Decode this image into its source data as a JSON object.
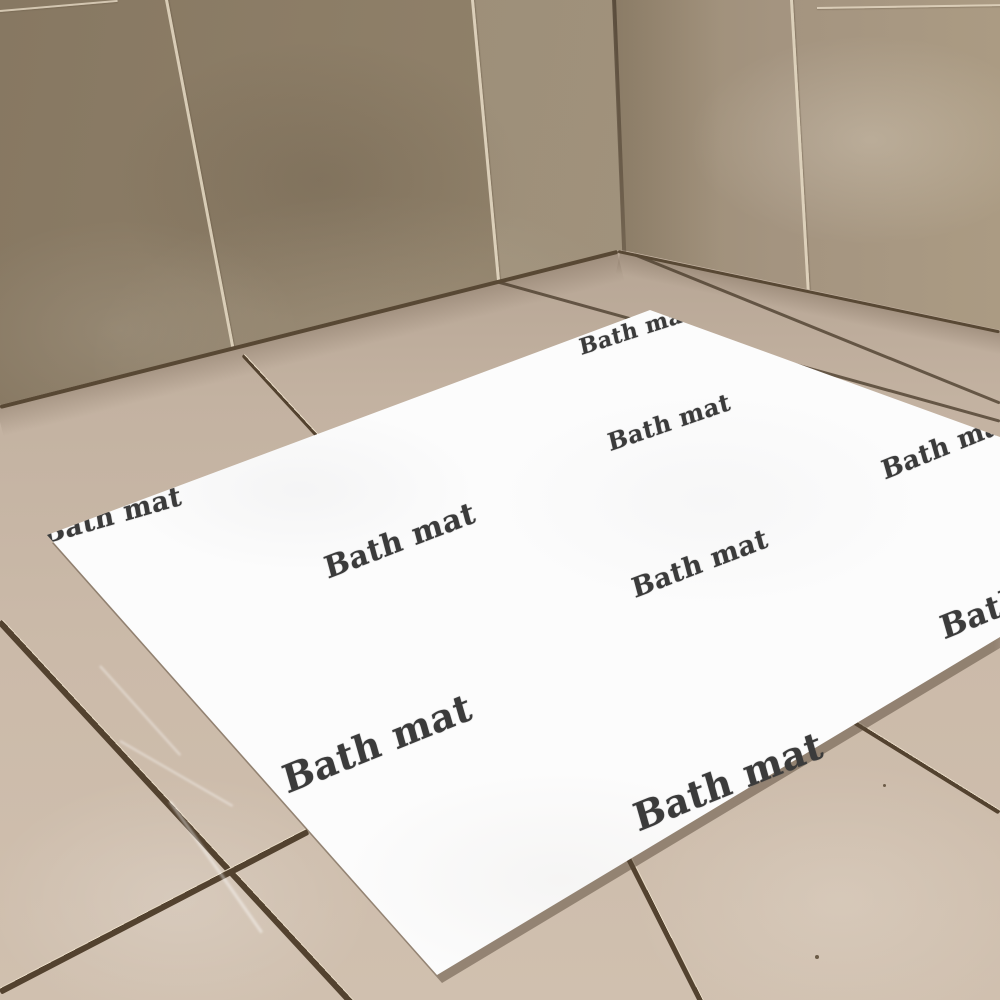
{
  "scene": {
    "type": "product-photo",
    "description": "A white bath mat printed with repeated 'Bath mat' text lying diagonally on large beige diagonal floor tiles in the corner of a beige-tiled bathroom",
    "mat_label": "Bath mat"
  },
  "palette": {
    "wall_left": "#8f8069",
    "wall_left_dark": "#877862",
    "wall_right": "#a49480",
    "wall_grout": "#e6dac4",
    "corner_shadow": "#544636",
    "floor": "#cbbaa9",
    "floor_dark": "#b7a695",
    "floor_light": "#d0c0af",
    "floor_grout": "#53422f",
    "floor_grout_highlight": "#e7dac5",
    "mat_white": "#fcfcfc",
    "mat_text_color": "#3b3b3b"
  },
  "mat_texts": [
    {
      "text": "Bath mat",
      "x": 636,
      "y": 330,
      "rot": -18,
      "size": 22,
      "overflow": false
    },
    {
      "text": "Bath mat",
      "x": 112,
      "y": 516,
      "rot": -16,
      "size": 27,
      "overflow": false
    },
    {
      "text": "Bath mat",
      "x": 400,
      "y": 541,
      "rot": -21,
      "size": 30,
      "overflow": false
    },
    {
      "text": "Bath mat",
      "x": 669,
      "y": 422,
      "rot": -19,
      "size": 24,
      "overflow": false
    },
    {
      "text": "Bath mat",
      "x": 947,
      "y": 446,
      "rot": -22,
      "size": 26,
      "overflow": false
    },
    {
      "text": "Bath mat",
      "x": 700,
      "y": 564,
      "rot": -21,
      "size": 27,
      "overflow": false
    },
    {
      "text": "Bath mat",
      "x": 377,
      "y": 743,
      "rot": -22,
      "size": 38,
      "overflow": false
    },
    {
      "text": "Bath mat",
      "x": 728,
      "y": 781,
      "rot": -22,
      "size": 38,
      "overflow": true
    },
    {
      "text": "Bath mat",
      "x": 1020,
      "y": 597,
      "rot": -22,
      "size": 32,
      "overflow": false
    }
  ]
}
